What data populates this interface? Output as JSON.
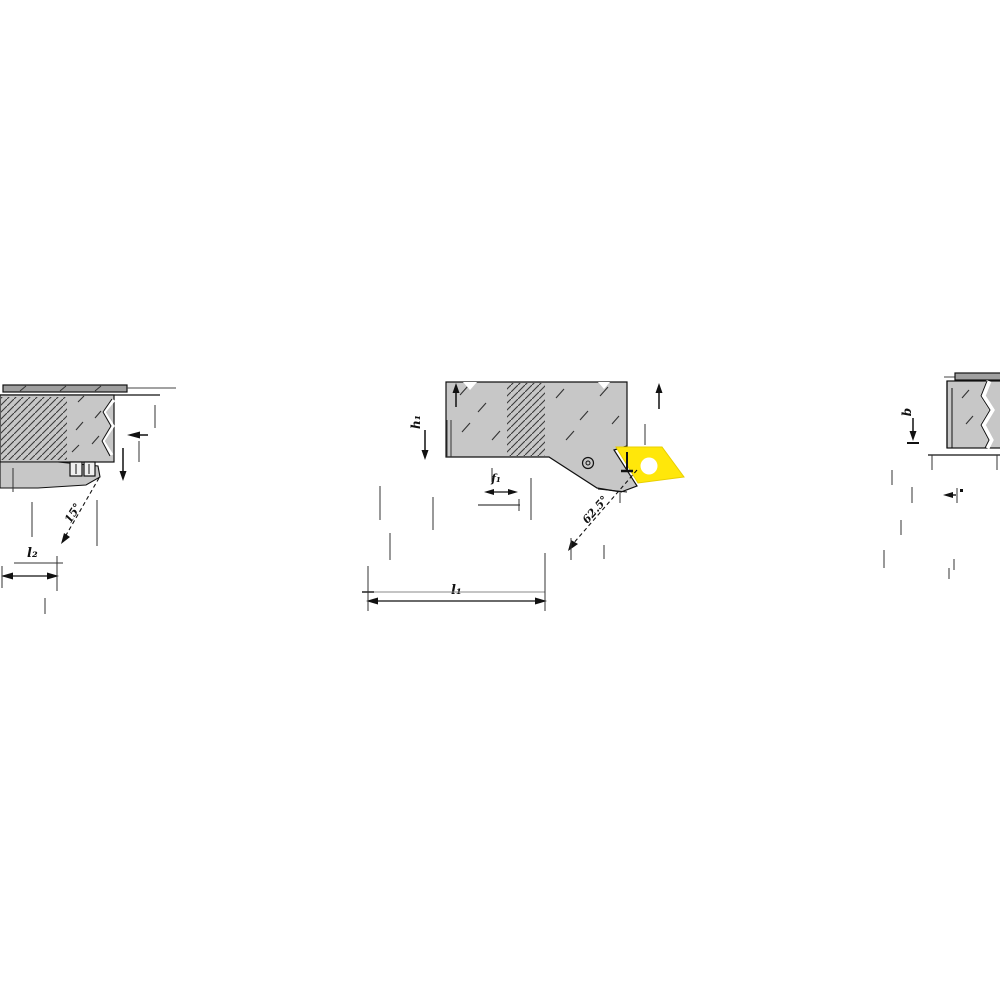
{
  "drawing": {
    "type": "technical-dimension-drawing",
    "description": "Lathe turning tool holder with yellow 55-degree rhombic insert, three orthographic views with dimension callouts",
    "colors": {
      "body_gray": "#c7c7c7",
      "bar_gray": "#9f9f9f",
      "hatch_dark": "#3a3a3a",
      "insert_yellow": "#ffe70a",
      "insert_edge": "#e8cf00",
      "hole_white": "#ffffff",
      "line_black": "#111111"
    },
    "front_view": {
      "dim_length_label": "l₂",
      "angle_label": "15°"
    },
    "side_view": {
      "dim_height_label": "h₁",
      "dim_offset_label": "f₁",
      "dim_length_label": "l₁",
      "angle_label": "62.5°"
    },
    "top_view": {
      "dim_width_label": "b"
    }
  }
}
